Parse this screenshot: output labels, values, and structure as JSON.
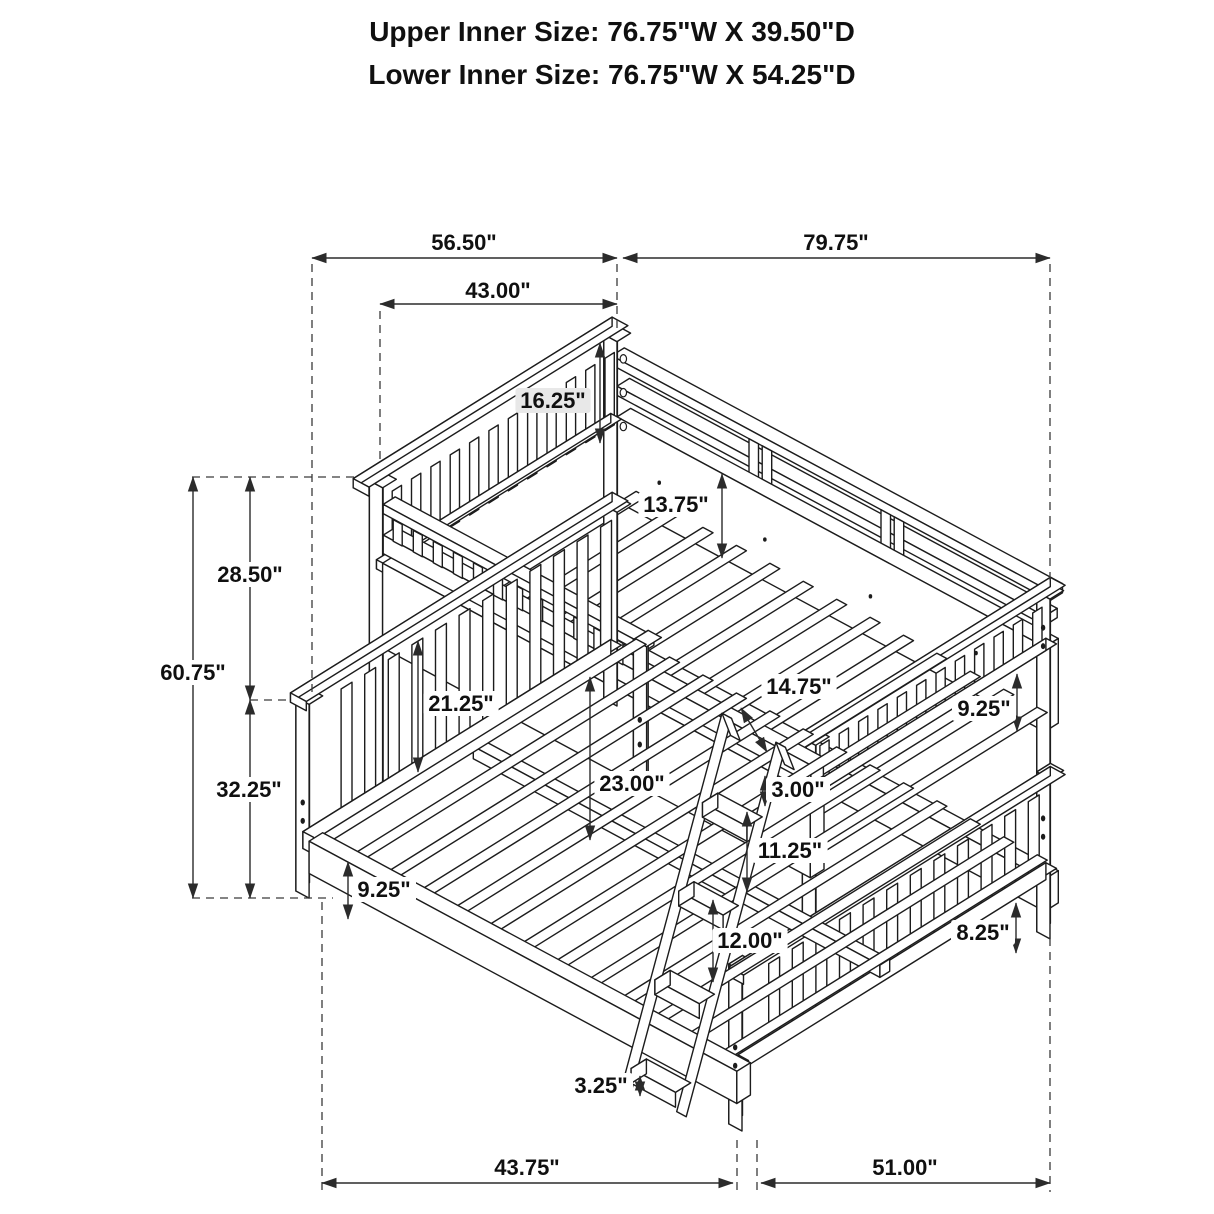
{
  "title": {
    "line1": "Upper Inner Size: 76.75\"W X 39.50\"D",
    "line2": "Lower Inner Size: 76.75\"W X 54.25\"D"
  },
  "dims": {
    "top_span_left": "56.50\"",
    "top_span_right": "79.75\"",
    "upper_headboard_width": "43.00\"",
    "upper_headboard_height": "16.25\"",
    "upper_side_rail_depth": "13.75\"",
    "upper_section_height": "28.50\"",
    "overall_height": "60.75\"",
    "lower_section_height": "32.25\"",
    "lower_headboard_panel_height": "21.25\"",
    "bunk_gap": "14.75\"",
    "under_bunk_clearance": "23.00\"",
    "ladder_top_gap": "3.00\"",
    "upper_footboard_gap": "9.25\"",
    "ladder_upper_rung_spacing": "11.25\"",
    "ladder_rung_spacing": "12.00\"",
    "ladder_foot_height": "3.25\"",
    "lower_footboard_clearance": "8.25\"",
    "lower_side_rail_height": "9.25\"",
    "bottom_span_left": "43.75\"",
    "bottom_span_right": "51.00\""
  },
  "colors": {
    "line": "#1c1c1c",
    "dimension": "#2b2b2b",
    "label_highlight_bg": "#e8e8e8"
  }
}
